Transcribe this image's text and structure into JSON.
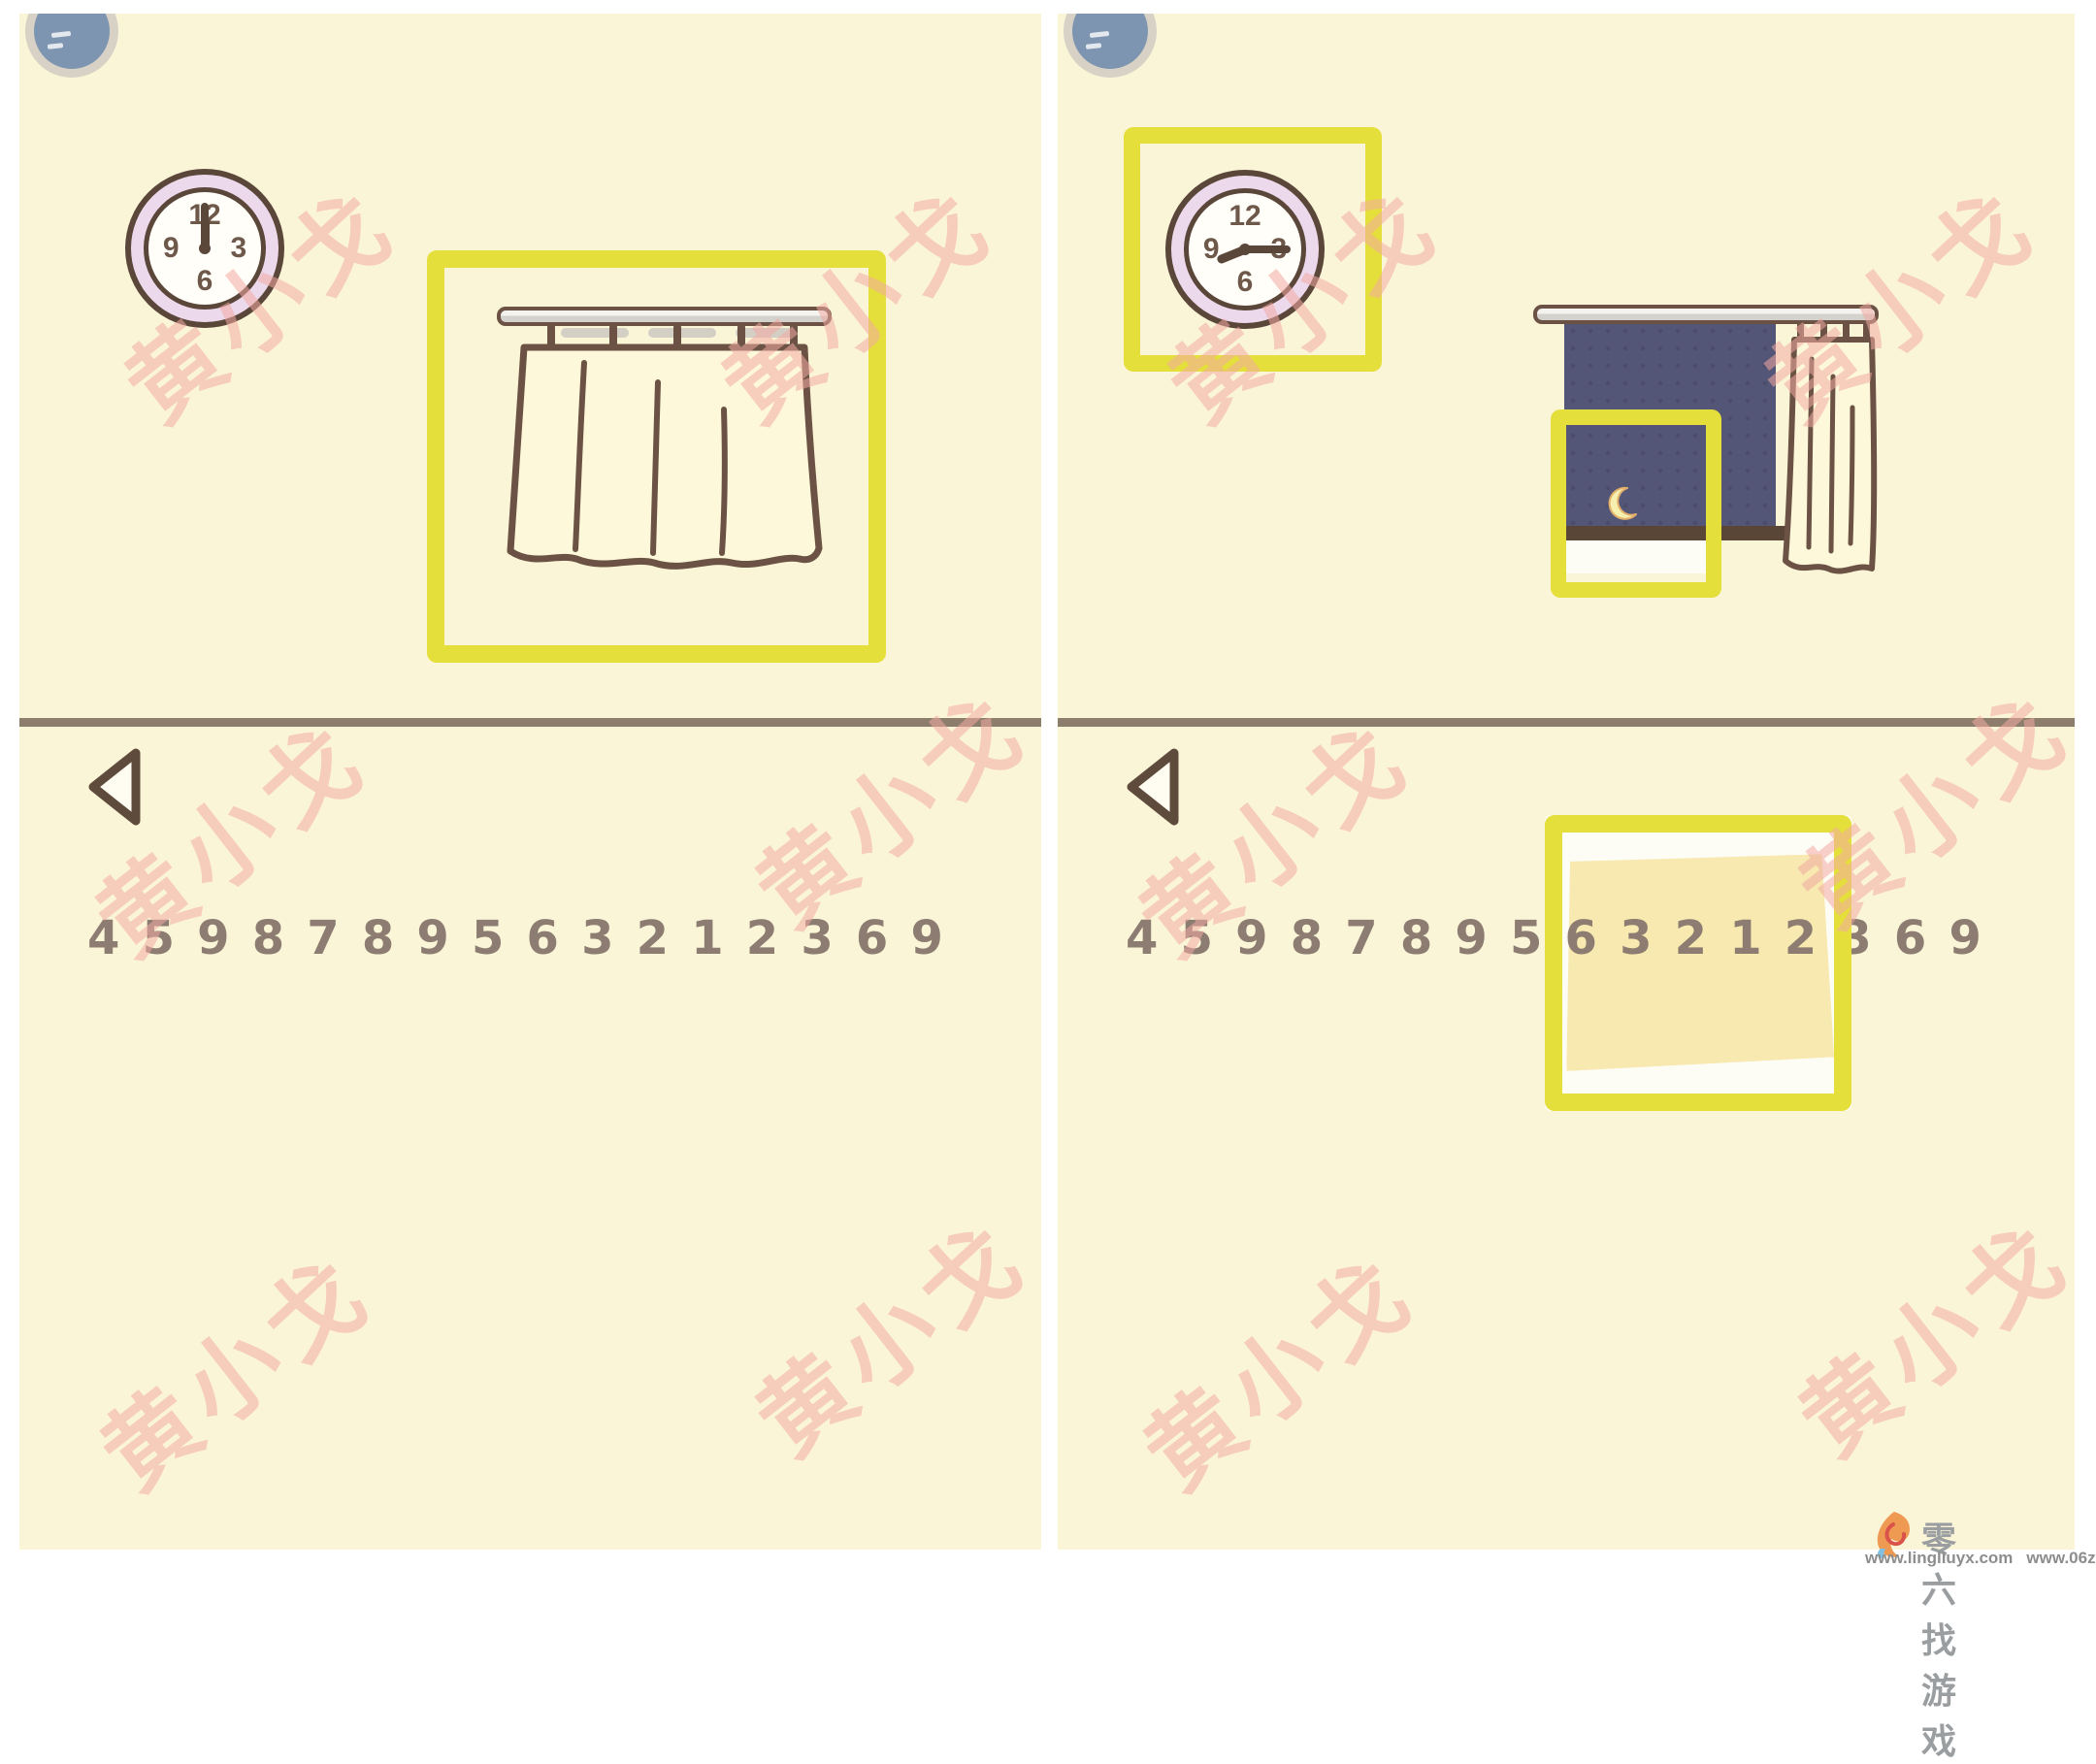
{
  "watermark": {
    "text": "黄小戈",
    "color": "#f3aaa3"
  },
  "colors": {
    "accent_yellow": "#e5df3b",
    "background_cream": "#fbf5d8",
    "window_navy": "#545677",
    "outline_brown": "#5b463a"
  },
  "clock_numbers": {
    "top": "12",
    "right": "3",
    "bottom": "6",
    "left": "9"
  },
  "digits": [
    "4",
    "5",
    "9",
    "8",
    "7",
    "8",
    "9",
    "5",
    "6",
    "3",
    "2",
    "1",
    "2",
    "3",
    "6",
    "9"
  ],
  "left_panel": {
    "scene": "curtain-closed",
    "time_shown": "12:00"
  },
  "right_panel": {
    "scene": "curtain-open-night-moon",
    "time_shown": "9:15",
    "note_highlighted_digits": "6 3 2 1 2"
  },
  "footer": {
    "site_name": "零六找游戏",
    "url_left": "www.lingliuyx.com",
    "url_right": "www.06zyx.com"
  }
}
